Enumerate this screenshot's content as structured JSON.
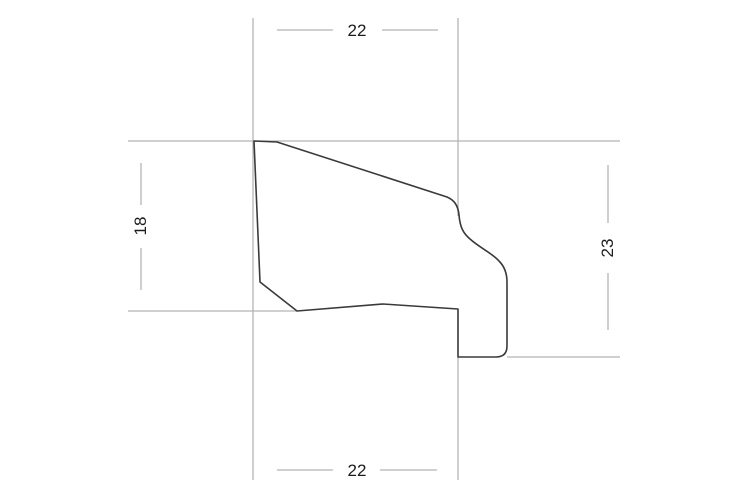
{
  "drawing": {
    "type": "profile-cross-section-technical-drawing",
    "colors": {
      "background": "#ffffff",
      "profile_line": "#3a3a3a",
      "dimension_line": "#b5b5b5",
      "text": "#1c1c1c"
    },
    "dimensions": {
      "top_width": {
        "label": "22",
        "orientation": "horizontal",
        "position": "top"
      },
      "left_height": {
        "label": "18",
        "orientation": "vertical",
        "position": "left"
      },
      "right_height": {
        "label": "23",
        "orientation": "vertical",
        "position": "right"
      },
      "bottom_width": {
        "label": "22",
        "orientation": "horizontal",
        "position": "bottom"
      }
    }
  }
}
